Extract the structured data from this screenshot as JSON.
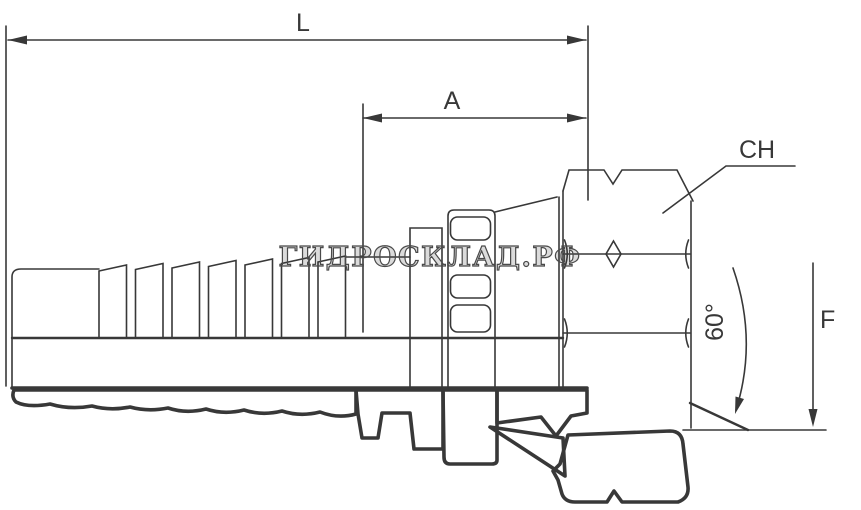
{
  "drawing": {
    "kind": "technical-drawing",
    "subject": "hydraulic hose fitting, female swivel nut with 60° cone, half-section view",
    "background_color": "#ffffff",
    "line_color": "#383838",
    "watermark": {
      "text": "ГИДРОСКЛАД.РФ"
    },
    "dimensions": {
      "overall_length": {
        "label": "L"
      },
      "section_length": {
        "label": "A"
      },
      "hex_size": {
        "label": "CH"
      },
      "cone_angle": {
        "label": "60°"
      },
      "thread": {
        "label": "F"
      }
    }
  }
}
